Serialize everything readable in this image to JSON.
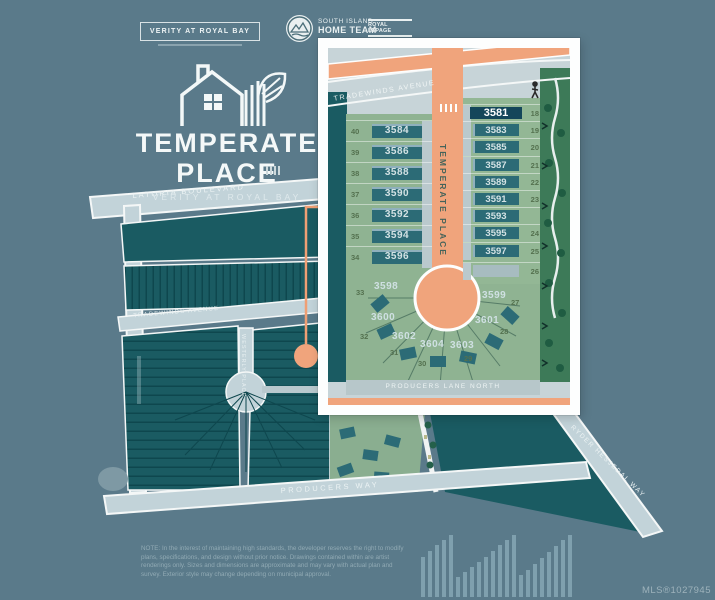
{
  "header": {
    "badge": "VERITY AT ROYAL BAY",
    "team_line1": "SOUTH ISLAND",
    "team_line2": "HOME TEAM",
    "brokerage_line1": "ROYAL LEPAGE",
    "brokerage_line2": "COAST CAPITAL REALTY"
  },
  "brand": {
    "title_line1": "TEMPERATE",
    "title_line2": "PLACE",
    "subtitle": "VERITY AT ROYAL BAY"
  },
  "map": {
    "streets": {
      "latoria": "LATORIA BOULEVARD",
      "tradewinds": "TRADEWINDS AVENUE",
      "westerly": "WESTERLY PLACE",
      "producers_way": "PRODUCERS WAY",
      "ryder": "RYDER HESJEDAL WAY"
    }
  },
  "inset": {
    "streets": {
      "tradewinds": "TRADEWINDS AVENUE",
      "temperate": "TEMPERATE PLACE",
      "producers_lane": "PRODUCERS LANE NORTH"
    },
    "left_lots": [
      {
        "lot": "40",
        "address": "3584"
      },
      {
        "lot": "39",
        "address": "3586"
      },
      {
        "lot": "38",
        "address": "3588"
      },
      {
        "lot": "37",
        "address": "3590"
      },
      {
        "lot": "36",
        "address": "3592"
      },
      {
        "lot": "35",
        "address": "3594"
      },
      {
        "lot": "34",
        "address": "3596"
      }
    ],
    "right_lots": [
      {
        "lot": "18",
        "address": "3581",
        "highlight": true
      },
      {
        "lot": "19",
        "address": "3583"
      },
      {
        "lot": "20",
        "address": "3585"
      },
      {
        "lot": "21",
        "address": "3587"
      },
      {
        "lot": "22",
        "address": "3589"
      },
      {
        "lot": "23",
        "address": "3591"
      },
      {
        "lot": "",
        "address": "3593"
      },
      {
        "lot": "24",
        "address": "3595"
      },
      {
        "lot": "25",
        "address": "3597"
      },
      {
        "lot": "26",
        "address": ""
      }
    ],
    "radial_lots": [
      {
        "lot": "33",
        "address": "3598"
      },
      {
        "lot": "32",
        "address": "3600"
      },
      {
        "lot": "31",
        "address": "3602"
      },
      {
        "lot": "30",
        "address": "3604"
      },
      {
        "lot": "29",
        "address": "3603"
      },
      {
        "lot": "28",
        "address": "3601"
      },
      {
        "lot": "27",
        "address": "3599"
      }
    ]
  },
  "colors": {
    "background": "#5a7a8a",
    "accent_orange": "#f0a47c",
    "lot_teal": "#1a5b62",
    "house_teal": "#2c6b76",
    "highlight_navy": "#14465a",
    "map_green": "#8fb392",
    "road_light": "#c2d3d9"
  },
  "footer": {
    "note": "NOTE: In the interest of maintaining high standards, the developer reserves the right to modify\nplans, specifications, and design without prior notice. Drawings contained within are artist\nrenderings only. Sizes and dimensions are approximate and may vary with actual plan and\nsurvey. Exterior style may change depending on municipal approval.",
    "mls": "MLS®1027945"
  }
}
